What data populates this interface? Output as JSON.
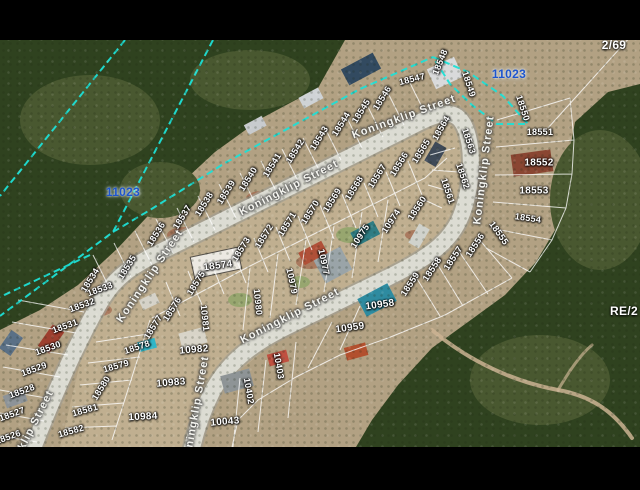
{
  "window": {
    "letterbox_color": "#000000",
    "map_offset_y": 40,
    "map_height": 407
  },
  "map": {
    "street_name": "Koningklip Street",
    "palette": {
      "letterbox": "#000000",
      "boundary_cyan": "#1ee0d6",
      "erf_label_blue": "#1d55cd",
      "street_fill": "#dcdcd3",
      "street_casing": "#a19d90",
      "parcel_line": "#ffffff",
      "bush_dark": "#2f421f",
      "bush_mid": "#495830",
      "scrub_tan": "#b2a183",
      "lots_tan": "#c2b193",
      "dirt_red": "#9c5a40",
      "track_tan": "#cbb393",
      "label_white": "#ffffff"
    },
    "boundary_labels": [
      {
        "text": "11023",
        "x": 123,
        "y": 192,
        "style": "blue"
      },
      {
        "text": "11023",
        "x": 509,
        "y": 74,
        "style": "blue"
      },
      {
        "text": "2/69",
        "x": 614,
        "y": 45,
        "style": "farm"
      },
      {
        "text": "RE/2",
        "x": 624,
        "y": 311,
        "style": "farm"
      }
    ],
    "street_labels": [
      {
        "text": "Koningklip Street",
        "x": 150,
        "y": 276,
        "rot": -56
      },
      {
        "text": "Koningklip Street",
        "x": 289,
        "y": 188,
        "rot": -27
      },
      {
        "text": "Koningklip Street",
        "x": 404,
        "y": 117,
        "rot": -20
      },
      {
        "text": "Koningklip Street",
        "x": 484,
        "y": 170,
        "rot": -83
      },
      {
        "text": "Koningklip Street",
        "x": 290,
        "y": 316,
        "rot": -27
      },
      {
        "text": "Koningklip Street",
        "x": 196,
        "y": 410,
        "rot": -80
      },
      {
        "text": "klip Street",
        "x": 36,
        "y": 420,
        "rot": -63
      }
    ],
    "parcel_labels": [
      {
        "text": "18534",
        "x": 90,
        "y": 280,
        "rot": -58
      },
      {
        "text": "18535",
        "x": 127,
        "y": 267,
        "rot": -58
      },
      {
        "text": "18536",
        "x": 156,
        "y": 234,
        "rot": -58
      },
      {
        "text": "18537",
        "x": 182,
        "y": 217,
        "rot": -58
      },
      {
        "text": "18538",
        "x": 204,
        "y": 204,
        "rot": -58
      },
      {
        "text": "18539",
        "x": 226,
        "y": 192,
        "rot": -58
      },
      {
        "text": "18540",
        "x": 248,
        "y": 179,
        "rot": -58
      },
      {
        "text": "18541",
        "x": 272,
        "y": 165,
        "rot": -58
      },
      {
        "text": "18542",
        "x": 295,
        "y": 151,
        "rot": -58
      },
      {
        "text": "18543",
        "x": 319,
        "y": 138,
        "rot": -58
      },
      {
        "text": "18544",
        "x": 341,
        "y": 124,
        "rot": -58
      },
      {
        "text": "18545",
        "x": 361,
        "y": 111,
        "rot": -58
      },
      {
        "text": "18546",
        "x": 382,
        "y": 98,
        "rot": -58
      },
      {
        "text": "18547",
        "x": 412,
        "y": 79,
        "rot": -14
      },
      {
        "text": "18548",
        "x": 440,
        "y": 62,
        "rot": -68
      },
      {
        "text": "18549",
        "x": 469,
        "y": 84,
        "rot": 72
      },
      {
        "text": "18550",
        "x": 523,
        "y": 108,
        "rot": 72
      },
      {
        "text": "18551",
        "x": 540,
        "y": 132,
        "rot": 0
      },
      {
        "text": "18552",
        "x": 539,
        "y": 163,
        "rot": 0,
        "size": 10
      },
      {
        "text": "18553",
        "x": 534,
        "y": 191,
        "rot": 0,
        "size": 10
      },
      {
        "text": "18554",
        "x": 528,
        "y": 218,
        "rot": 8
      },
      {
        "text": "18555",
        "x": 499,
        "y": 233,
        "rot": 55
      },
      {
        "text": "18556",
        "x": 475,
        "y": 245,
        "rot": -57
      },
      {
        "text": "18557",
        "x": 453,
        "y": 258,
        "rot": -57
      },
      {
        "text": "18558",
        "x": 432,
        "y": 269,
        "rot": -57
      },
      {
        "text": "18559",
        "x": 410,
        "y": 284,
        "rot": -57
      },
      {
        "text": "18560",
        "x": 417,
        "y": 208,
        "rot": -57
      },
      {
        "text": "18561",
        "x": 448,
        "y": 191,
        "rot": 72
      },
      {
        "text": "18562",
        "x": 463,
        "y": 176,
        "rot": 72
      },
      {
        "text": "18563",
        "x": 469,
        "y": 141,
        "rot": 72
      },
      {
        "text": "18564",
        "x": 441,
        "y": 128,
        "rot": -60
      },
      {
        "text": "18565",
        "x": 421,
        "y": 151,
        "rot": -58
      },
      {
        "text": "18566",
        "x": 399,
        "y": 164,
        "rot": -58
      },
      {
        "text": "18567",
        "x": 377,
        "y": 176,
        "rot": -58
      },
      {
        "text": "18568",
        "x": 354,
        "y": 188,
        "rot": -58
      },
      {
        "text": "18569",
        "x": 332,
        "y": 200,
        "rot": -58
      },
      {
        "text": "18570",
        "x": 310,
        "y": 212,
        "rot": -58
      },
      {
        "text": "18571",
        "x": 287,
        "y": 224,
        "rot": -58
      },
      {
        "text": "18572",
        "x": 264,
        "y": 236,
        "rot": -58
      },
      {
        "text": "18573",
        "x": 241,
        "y": 249,
        "rot": -58
      },
      {
        "text": "18574",
        "x": 218,
        "y": 266,
        "rot": -8,
        "size": 10
      },
      {
        "text": "18575",
        "x": 196,
        "y": 283,
        "rot": -58
      },
      {
        "text": "18576",
        "x": 172,
        "y": 309,
        "rot": -58
      },
      {
        "text": "18577",
        "x": 153,
        "y": 327,
        "rot": -58
      },
      {
        "text": "18578",
        "x": 137,
        "y": 347,
        "rot": -18
      },
      {
        "text": "18579",
        "x": 116,
        "y": 366,
        "rot": -16
      },
      {
        "text": "18580",
        "x": 101,
        "y": 388,
        "rot": -58
      },
      {
        "text": "18581",
        "x": 85,
        "y": 410,
        "rot": -16
      },
      {
        "text": "18582",
        "x": 71,
        "y": 431,
        "rot": -16
      },
      {
        "text": "18533",
        "x": 100,
        "y": 289,
        "rot": -20
      },
      {
        "text": "18532",
        "x": 82,
        "y": 305,
        "rot": -20
      },
      {
        "text": "18531",
        "x": 65,
        "y": 326,
        "rot": -20
      },
      {
        "text": "18530",
        "x": 48,
        "y": 348,
        "rot": -20
      },
      {
        "text": "18529",
        "x": 34,
        "y": 369,
        "rot": -20
      },
      {
        "text": "18528",
        "x": 22,
        "y": 391,
        "rot": -20
      },
      {
        "text": "18527",
        "x": 12,
        "y": 414,
        "rot": -20
      },
      {
        "text": "18526",
        "x": 8,
        "y": 437,
        "rot": -20
      },
      {
        "text": "10974",
        "x": 391,
        "y": 221,
        "rot": -57
      },
      {
        "text": "10975",
        "x": 360,
        "y": 236,
        "rot": -57
      },
      {
        "text": "10977",
        "x": 324,
        "y": 262,
        "rot": 78
      },
      {
        "text": "10979",
        "x": 292,
        "y": 281,
        "rot": 78
      },
      {
        "text": "10980",
        "x": 258,
        "y": 302,
        "rot": 84
      },
      {
        "text": "10981",
        "x": 205,
        "y": 318,
        "rot": 84
      },
      {
        "text": "10982",
        "x": 194,
        "y": 350,
        "rot": -5,
        "size": 10
      },
      {
        "text": "10983",
        "x": 171,
        "y": 383,
        "rot": -5,
        "size": 10
      },
      {
        "text": "10984",
        "x": 143,
        "y": 417,
        "rot": -3,
        "size": 10
      },
      {
        "text": "10958",
        "x": 380,
        "y": 305,
        "rot": -8,
        "size": 10
      },
      {
        "text": "10959",
        "x": 350,
        "y": 328,
        "rot": -8,
        "size": 10
      },
      {
        "text": "10403",
        "x": 279,
        "y": 366,
        "rot": 80
      },
      {
        "text": "10402",
        "x": 249,
        "y": 391,
        "rot": 80
      },
      {
        "text": "10043",
        "x": 225,
        "y": 422,
        "rot": -5,
        "size": 10
      }
    ]
  }
}
